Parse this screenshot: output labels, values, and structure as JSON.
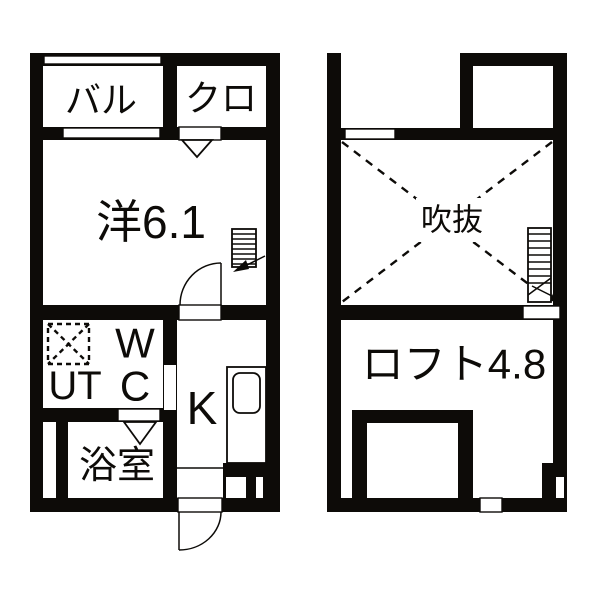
{
  "document": {
    "kind": "apartment-floor-plan",
    "panels": 2
  },
  "colors": {
    "ink": "#0d0b08",
    "paper": "#ffffff"
  },
  "plans": {
    "first_floor": {
      "rooms": [
        {
          "name": "balcony",
          "label": "バル"
        },
        {
          "name": "closet",
          "label": "クロ"
        },
        {
          "name": "western-room",
          "label": "洋6.1"
        },
        {
          "name": "toilet-utility",
          "w": "W",
          "c": "C",
          "ut": "UT"
        },
        {
          "name": "kitchen",
          "label": "K"
        },
        {
          "name": "bathroom",
          "label": "浴室"
        }
      ]
    },
    "second_floor": {
      "rooms": [
        {
          "name": "void",
          "label": "吹抜"
        },
        {
          "name": "loft",
          "label": "ロフト4.8"
        }
      ]
    }
  }
}
